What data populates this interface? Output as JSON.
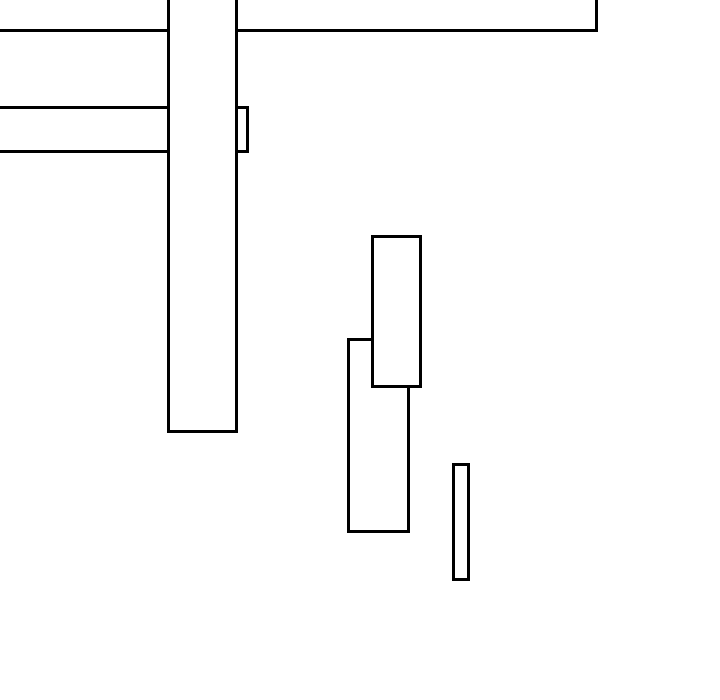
{
  "canvas": {
    "width": 720,
    "height": 700,
    "background_color": "#ffffff"
  },
  "style": {
    "stroke_color": "#000000",
    "fill_color": "#ffffff",
    "stroke_width": 3
  },
  "shapes": [
    {
      "name": "top-banner-rect",
      "x": -24,
      "y": -60,
      "w": 622,
      "h": 92,
      "z": 1,
      "note": "large rectangle extending off-screen top and left; visible bottom edge at y~31 and right edge at x~597"
    },
    {
      "name": "left-horizontal-rect",
      "x": -24,
      "y": 106,
      "w": 273,
      "h": 47,
      "z": 2,
      "note": "horizontal rectangle extending off-screen left; visible edges at y~107 and y~151, right end x~248 protruding past the tall bar"
    },
    {
      "name": "tall-vertical-bar",
      "x": 167,
      "y": -30,
      "w": 71,
      "h": 463,
      "z": 3,
      "note": "tall white-filled bar extending off-screen top; occludes the two rectangles behind it; bottom at y~432"
    },
    {
      "name": "lower-left-rect",
      "x": 347,
      "y": 338,
      "w": 63,
      "h": 195,
      "z": 4,
      "note": "rectangle partially hidden behind upper-middle-rect at its top-right"
    },
    {
      "name": "upper-middle-rect",
      "x": 371,
      "y": 235,
      "w": 51,
      "h": 153,
      "z": 5,
      "note": "rectangle drawn on top of lower-left-rect"
    },
    {
      "name": "thin-vertical-rect",
      "x": 452,
      "y": 463,
      "w": 18,
      "h": 118,
      "z": 6,
      "note": "small thin standalone rectangle"
    }
  ]
}
